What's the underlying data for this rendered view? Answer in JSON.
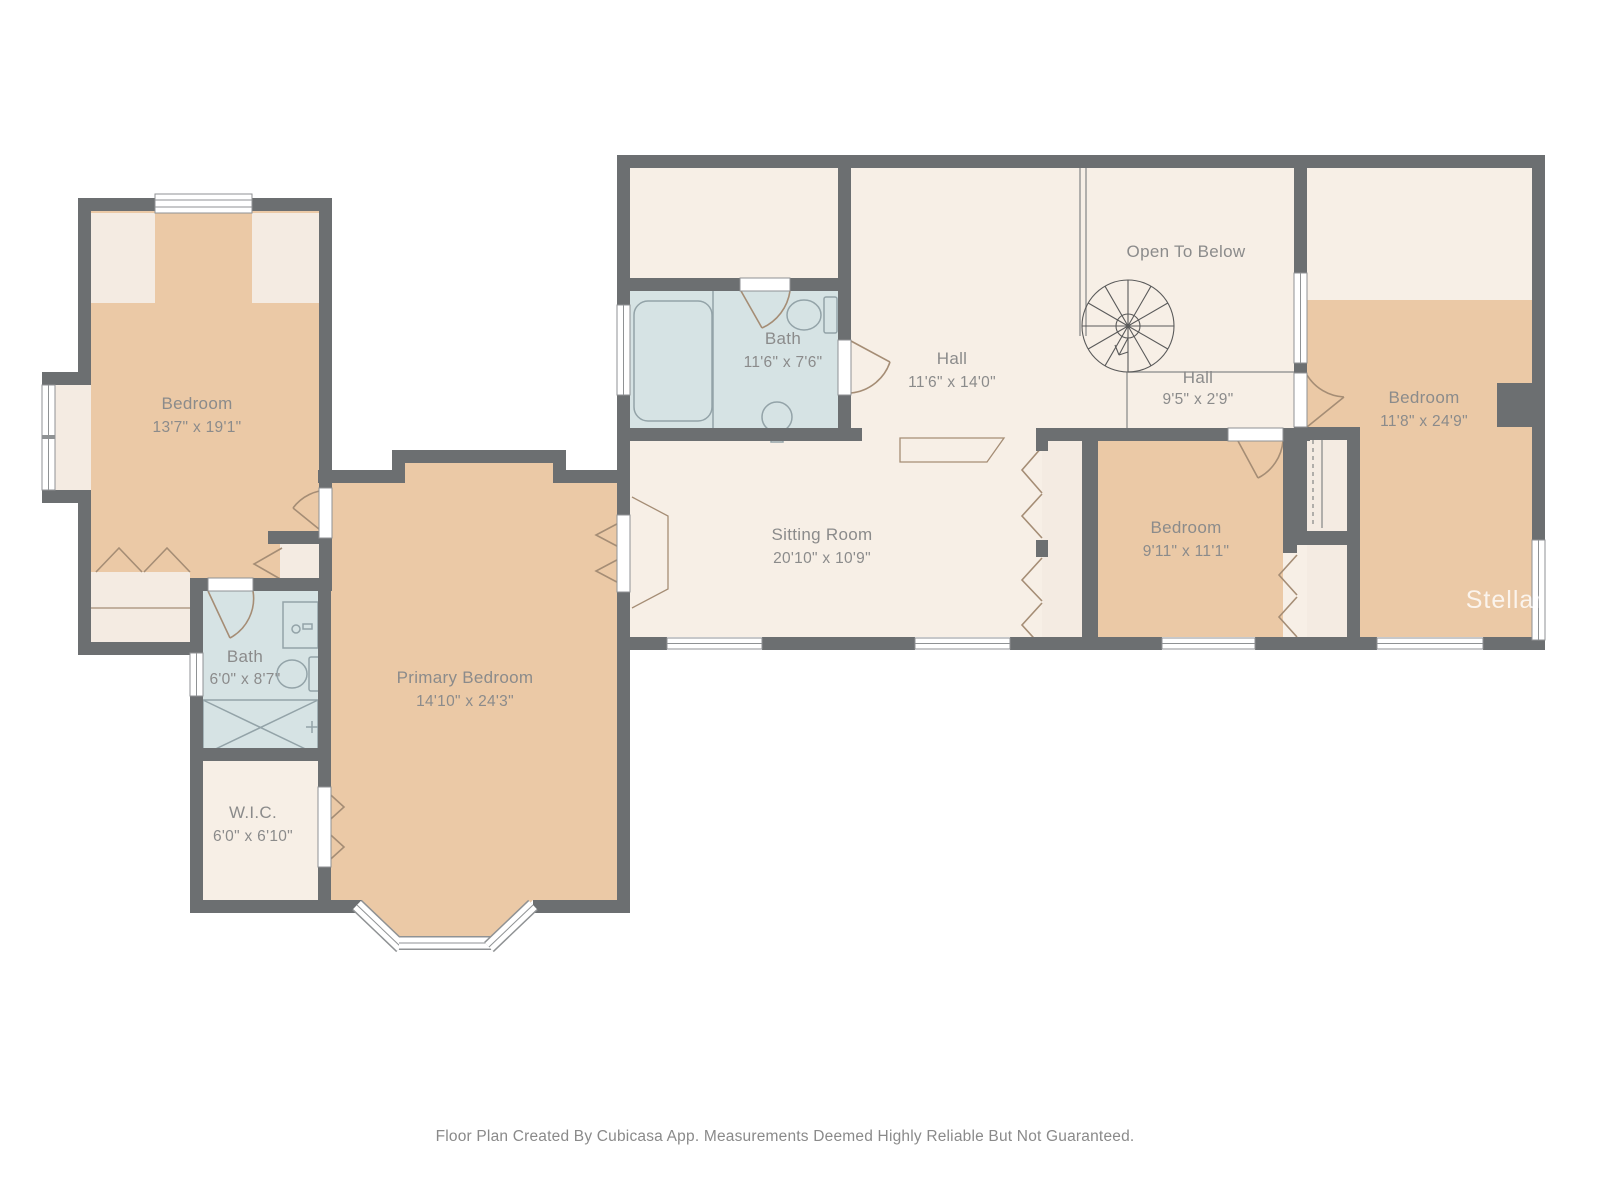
{
  "rooms": {
    "bedroom_left": {
      "name": "Bedroom",
      "dims": "13'7\" x 19'1\""
    },
    "bath_left": {
      "name": "Bath",
      "dims": "6'0\" x 8'7\""
    },
    "wic": {
      "name": "W.I.C.",
      "dims": "6'0\" x 6'10\""
    },
    "primary": {
      "name": "Primary Bedroom",
      "dims": "14'10\" x 24'3\""
    },
    "bath_mid": {
      "name": "Bath",
      "dims": "11'6\" x 7'6\""
    },
    "hall_main": {
      "name": "Hall",
      "dims": "11'6\" x 14'0\""
    },
    "open_to_below": {
      "name": "Open To Below",
      "dims": ""
    },
    "hall_small": {
      "name": "Hall",
      "dims": "9'5\" x 2'9\""
    },
    "bedroom_right": {
      "name": "Bedroom",
      "dims": "11'8\" x 24'9\""
    },
    "bedroom_mid": {
      "name": "Bedroom",
      "dims": "9'11\" x 11'1\""
    },
    "sitting_room": {
      "name": "Sitting Room",
      "dims": "20'10\" x 10'9\""
    }
  },
  "footer": "Floor Plan Created By Cubicasa App. Measurements Deemed Highly Reliable But Not Guaranteed.",
  "watermark": "StellarMLS",
  "colors": {
    "wall": "#6c6f71",
    "floor": "#f7efe6",
    "bedroom_floor": "#ebc9a6",
    "bath_floor": "#d6e3e4",
    "furniture": "#f4ebe2",
    "label": "#8b8b8b",
    "door_arc": "#a58d75",
    "fixture": "#93a3a8"
  }
}
